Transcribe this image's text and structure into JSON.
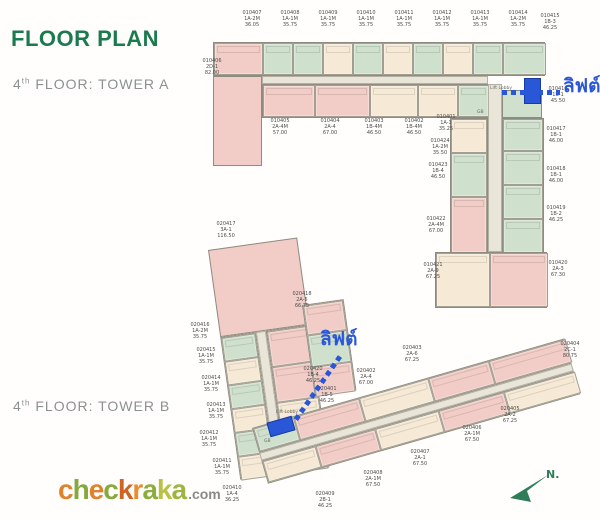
{
  "page_title": "FLOOR PLAN",
  "headings": {
    "tower_a": {
      "floor": "4",
      "ordinal": "th",
      "label": " FLOOR: TOWER A"
    },
    "tower_b": {
      "floor": "4",
      "ordinal": "th",
      "label": " FLOOR: TOWER B"
    }
  },
  "annotations": {
    "lift_a": "ลิฟต์",
    "lift_b": "ลิฟต์",
    "lift_lobby": "Lift Lobby",
    "gb": "GB",
    "compass": "N."
  },
  "logo": {
    "letters": [
      {
        "ch": "c",
        "color": "#e0812c"
      },
      {
        "ch": "h",
        "color": "#85a93c"
      },
      {
        "ch": "e",
        "color": "#e0812c"
      },
      {
        "ch": "c",
        "color": "#85a93c"
      },
      {
        "ch": "k",
        "color": "#cf6423"
      },
      {
        "ch": "r",
        "color": "#e88e2f"
      },
      {
        "ch": "a",
        "color": "#8cad3c"
      },
      {
        "ch": "k",
        "color": "#b9c246"
      },
      {
        "ch": "a",
        "color": "#9db53f"
      }
    ],
    "suffix": ".com"
  },
  "colors": {
    "title_green": "#1b7a4e",
    "heading_gray": "#8b9190",
    "lift_blue": "#2a57d8",
    "compass_green": "#2e7d58",
    "palette": {
      "pink": "#f2ccc6",
      "green": "#cfe0cd",
      "cream": "#f6e9d5",
      "peach": "#f3dcc3",
      "gray": "#e4e4da",
      "corridor": "#e9e5d8"
    }
  },
  "tower_a": {
    "unit_labels": [
      {
        "id": "010407",
        "type": "1A-2M",
        "area": "36.05",
        "x": 230,
        "y": 10
      },
      {
        "id": "010408",
        "type": "1A-1M",
        "area": "35.75",
        "x": 268,
        "y": 10
      },
      {
        "id": "010409",
        "type": "1A-1M",
        "area": "35.75",
        "x": 306,
        "y": 10
      },
      {
        "id": "010410",
        "type": "1A-1M",
        "area": "35.75",
        "x": 344,
        "y": 10
      },
      {
        "id": "010411",
        "type": "1A-1M",
        "area": "35.75",
        "x": 382,
        "y": 10
      },
      {
        "id": "010412",
        "type": "1A-1M",
        "area": "35.75",
        "x": 420,
        "y": 10
      },
      {
        "id": "010413",
        "type": "1A-1M",
        "area": "35.75",
        "x": 458,
        "y": 10
      },
      {
        "id": "010414",
        "type": "1A-2M",
        "area": "35.75",
        "x": 496,
        "y": 10
      },
      {
        "id": "010415",
        "type": "1B-3",
        "area": "46.25",
        "x": 528,
        "y": 13
      },
      {
        "id": "010406",
        "type": "2D-1",
        "area": "82.00",
        "x": 190,
        "y": 58
      },
      {
        "id": "010405",
        "type": "2A-4M",
        "area": "57.00",
        "x": 258,
        "y": 118
      },
      {
        "id": "010404",
        "type": "2A-4",
        "area": "67.00",
        "x": 308,
        "y": 118
      },
      {
        "id": "010403",
        "type": "1B-4M",
        "area": "46.50",
        "x": 352,
        "y": 118
      },
      {
        "id": "010402",
        "type": "1B-4M",
        "area": "46.50",
        "x": 392,
        "y": 118
      },
      {
        "id": "010401",
        "type": "1A-1",
        "area": "35.25",
        "x": 424,
        "y": 114
      },
      {
        "id": "010416",
        "type": "1B-1",
        "area": "45.50",
        "x": 536,
        "y": 86
      },
      {
        "id": "010417",
        "type": "1B-1",
        "area": "46.00",
        "x": 534,
        "y": 126
      },
      {
        "id": "010418",
        "type": "1B-1",
        "area": "46.00",
        "x": 534,
        "y": 166
      },
      {
        "id": "010419",
        "type": "1B-2",
        "area": "46.25",
        "x": 534,
        "y": 205
      },
      {
        "id": "010424",
        "type": "1A-2M",
        "area": "35.50",
        "x": 418,
        "y": 138
      },
      {
        "id": "010423",
        "type": "1B-4",
        "area": "46.50",
        "x": 416,
        "y": 162
      },
      {
        "id": "010422",
        "type": "2A-4M",
        "area": "67.00",
        "x": 414,
        "y": 216
      },
      {
        "id": "010421",
        "type": "2A-9",
        "area": "67.25",
        "x": 411,
        "y": 262
      },
      {
        "id": "010420",
        "type": "2A-3",
        "area": "67.30",
        "x": 536,
        "y": 260
      }
    ],
    "top_cells": [
      {
        "w": 49,
        "color": "pink"
      },
      {
        "w": 30,
        "color": "green"
      },
      {
        "w": 30,
        "color": "green"
      },
      {
        "w": 30,
        "color": "cream"
      },
      {
        "w": 30,
        "color": "green"
      },
      {
        "w": 30,
        "color": "cream"
      },
      {
        "w": 30,
        "color": "green"
      },
      {
        "w": 30,
        "color": "cream"
      },
      {
        "w": 30,
        "color": "green"
      },
      {
        "w": 43,
        "color": "green"
      }
    ],
    "bottom_cells": [
      {
        "w": 52,
        "color": "pink"
      },
      {
        "w": 55,
        "color": "pink"
      },
      {
        "w": 48,
        "color": "cream"
      },
      {
        "w": 40,
        "color": "cream"
      },
      {
        "w": 31,
        "color": "green"
      }
    ],
    "right_col_cells": [
      {
        "h": 32,
        "color": "green"
      },
      {
        "h": 34,
        "color": "green"
      },
      {
        "h": 34,
        "color": "green"
      },
      {
        "h": 34,
        "color": "green"
      }
    ],
    "left_col_cells": [
      {
        "h": 34,
        "color": "cream"
      },
      {
        "h": 44,
        "color": "green"
      },
      {
        "h": 56,
        "color": "pink"
      }
    ],
    "bottom_block_cells": [
      {
        "w": 54,
        "color": "cream"
      },
      {
        "w": 58,
        "color": "pink"
      }
    ]
  },
  "tower_b": {
    "unit_labels": [
      {
        "id": "020417",
        "type": "3A-1",
        "area": "116.50",
        "x": 204,
        "y": 221
      },
      {
        "id": "020418",
        "type": "2A-5",
        "area": "66.75",
        "x": 280,
        "y": 291
      },
      {
        "id": "020416",
        "type": "1A-2M",
        "area": "35.75",
        "x": 178,
        "y": 322
      },
      {
        "id": "020415",
        "type": "1A-1M",
        "area": "35.75",
        "x": 184,
        "y": 347
      },
      {
        "id": "020414",
        "type": "1A-1M",
        "area": "35.75",
        "x": 189,
        "y": 375
      },
      {
        "id": "020413",
        "type": "1A-1M",
        "area": "35.75",
        "x": 194,
        "y": 402
      },
      {
        "id": "020412",
        "type": "1A-1M",
        "area": "35.75",
        "x": 187,
        "y": 430
      },
      {
        "id": "020411",
        "type": "1A-1M",
        "area": "35.75",
        "x": 200,
        "y": 458
      },
      {
        "id": "020410",
        "type": "1A-4",
        "area": "36.25",
        "x": 210,
        "y": 485
      },
      {
        "id": "020420",
        "type": "1B-4",
        "area": "46.25",
        "x": 291,
        "y": 366
      },
      {
        "id": "020401",
        "type": "1B-5",
        "area": "46.25",
        "x": 305,
        "y": 386
      },
      {
        "id": "020402",
        "type": "2A-4",
        "area": "67.00",
        "x": 344,
        "y": 368
      },
      {
        "id": "020403",
        "type": "2A-6",
        "area": "67.25",
        "x": 390,
        "y": 345
      },
      {
        "id": "020404",
        "type": "2C-1",
        "area": "80.75",
        "x": 548,
        "y": 341
      },
      {
        "id": "020405",
        "type": "2A-2",
        "area": "67.25",
        "x": 488,
        "y": 406
      },
      {
        "id": "020406",
        "type": "2A-1M",
        "area": "67.50",
        "x": 450,
        "y": 425
      },
      {
        "id": "020407",
        "type": "2A-1",
        "area": "67.50",
        "x": 398,
        "y": 449
      },
      {
        "id": "020408",
        "type": "2A-1M",
        "area": "67.50",
        "x": 351,
        "y": 470
      },
      {
        "id": "020409",
        "type": "2B-1",
        "area": "46.25",
        "x": 303,
        "y": 491
      }
    ],
    "vert_left_cells": [
      {
        "h": 24,
        "color": "green"
      },
      {
        "h": 24,
        "color": "cream"
      },
      {
        "h": 24,
        "color": "green"
      },
      {
        "h": 24,
        "color": "cream"
      },
      {
        "h": 24,
        "color": "green"
      },
      {
        "h": 24,
        "color": "cream"
      }
    ],
    "vert_right_cells": [
      {
        "h": 36,
        "color": "pink"
      },
      {
        "h": 36,
        "color": "pink"
      },
      {
        "h": 36,
        "color": "cream"
      },
      {
        "h": 36,
        "color": "pink"
      }
    ],
    "junction_cells": [
      {
        "h": 30,
        "color": "pink"
      },
      {
        "h": 32,
        "color": "green"
      },
      {
        "h": 30,
        "color": "pink"
      }
    ],
    "horiz_top_cells": [
      {
        "w": 42,
        "color": "green"
      },
      {
        "w": 68,
        "color": "pink"
      },
      {
        "w": 72,
        "color": "cream"
      },
      {
        "w": 63,
        "color": "pink"
      },
      {
        "w": 80,
        "color": "pink"
      }
    ],
    "horiz_bottom_cells": [
      {
        "w": 55,
        "color": "cream"
      },
      {
        "w": 62,
        "color": "pink"
      },
      {
        "w": 66,
        "color": "cream"
      },
      {
        "w": 68,
        "color": "pink"
      },
      {
        "w": 74,
        "color": "cream"
      }
    ]
  }
}
